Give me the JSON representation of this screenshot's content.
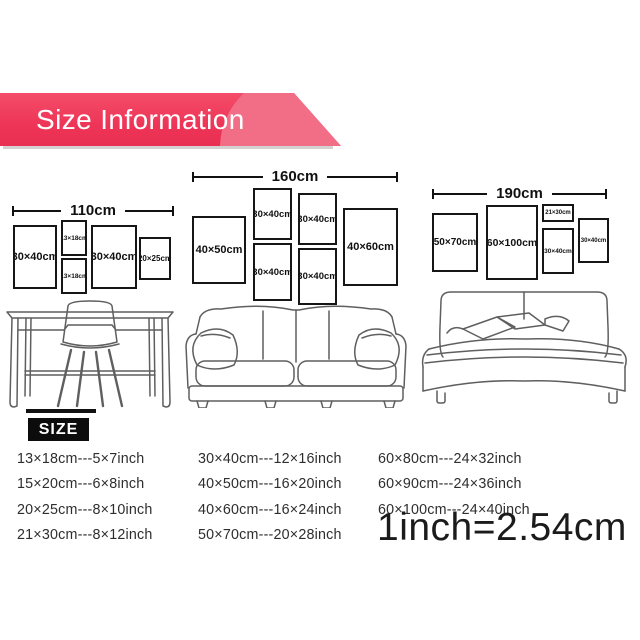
{
  "banner": {
    "title": "Size Information",
    "accent_color": "#ee3557",
    "swoosh_color": "#f26e87"
  },
  "groups": [
    {
      "name": "desk-wall",
      "width_label": "110cm",
      "frames": [
        {
          "label": "30×40cm"
        },
        {
          "label": "13×18cm"
        },
        {
          "label": "13×18cm"
        },
        {
          "label": "30×40cm"
        },
        {
          "label": "20×25cm"
        }
      ]
    },
    {
      "name": "sofa-wall",
      "width_label": "160cm",
      "frames": [
        {
          "label": "40×50cm"
        },
        {
          "label": "30×40cm"
        },
        {
          "label": "30×40cm"
        },
        {
          "label": "30×40cm"
        },
        {
          "label": "30×40cm"
        },
        {
          "label": "40×60cm"
        }
      ]
    },
    {
      "name": "bed-wall",
      "width_label": "190cm",
      "frames": [
        {
          "label": "50×70cm"
        },
        {
          "label": "60×100cm"
        },
        {
          "label": "21×30cm"
        },
        {
          "label": "30×40cm"
        },
        {
          "label": "30×40cm"
        }
      ]
    }
  ],
  "size_table": {
    "header": "SIZE",
    "columns": [
      [
        "13×18cm---5×7inch",
        "15×20cm---6×8inch",
        "20×25cm---8×10inch",
        "21×30cm---8×12inch"
      ],
      [
        "30×40cm---12×16inch",
        "40×50cm---16×20inch",
        "40×60cm---16×24inch",
        "50×70cm---20×28inch"
      ],
      [
        "60×80cm---24×32inch",
        "60×90cm---24×36inch",
        "60×100cm---24×40inch"
      ]
    ],
    "conversion": "1inch=2.54cm"
  }
}
